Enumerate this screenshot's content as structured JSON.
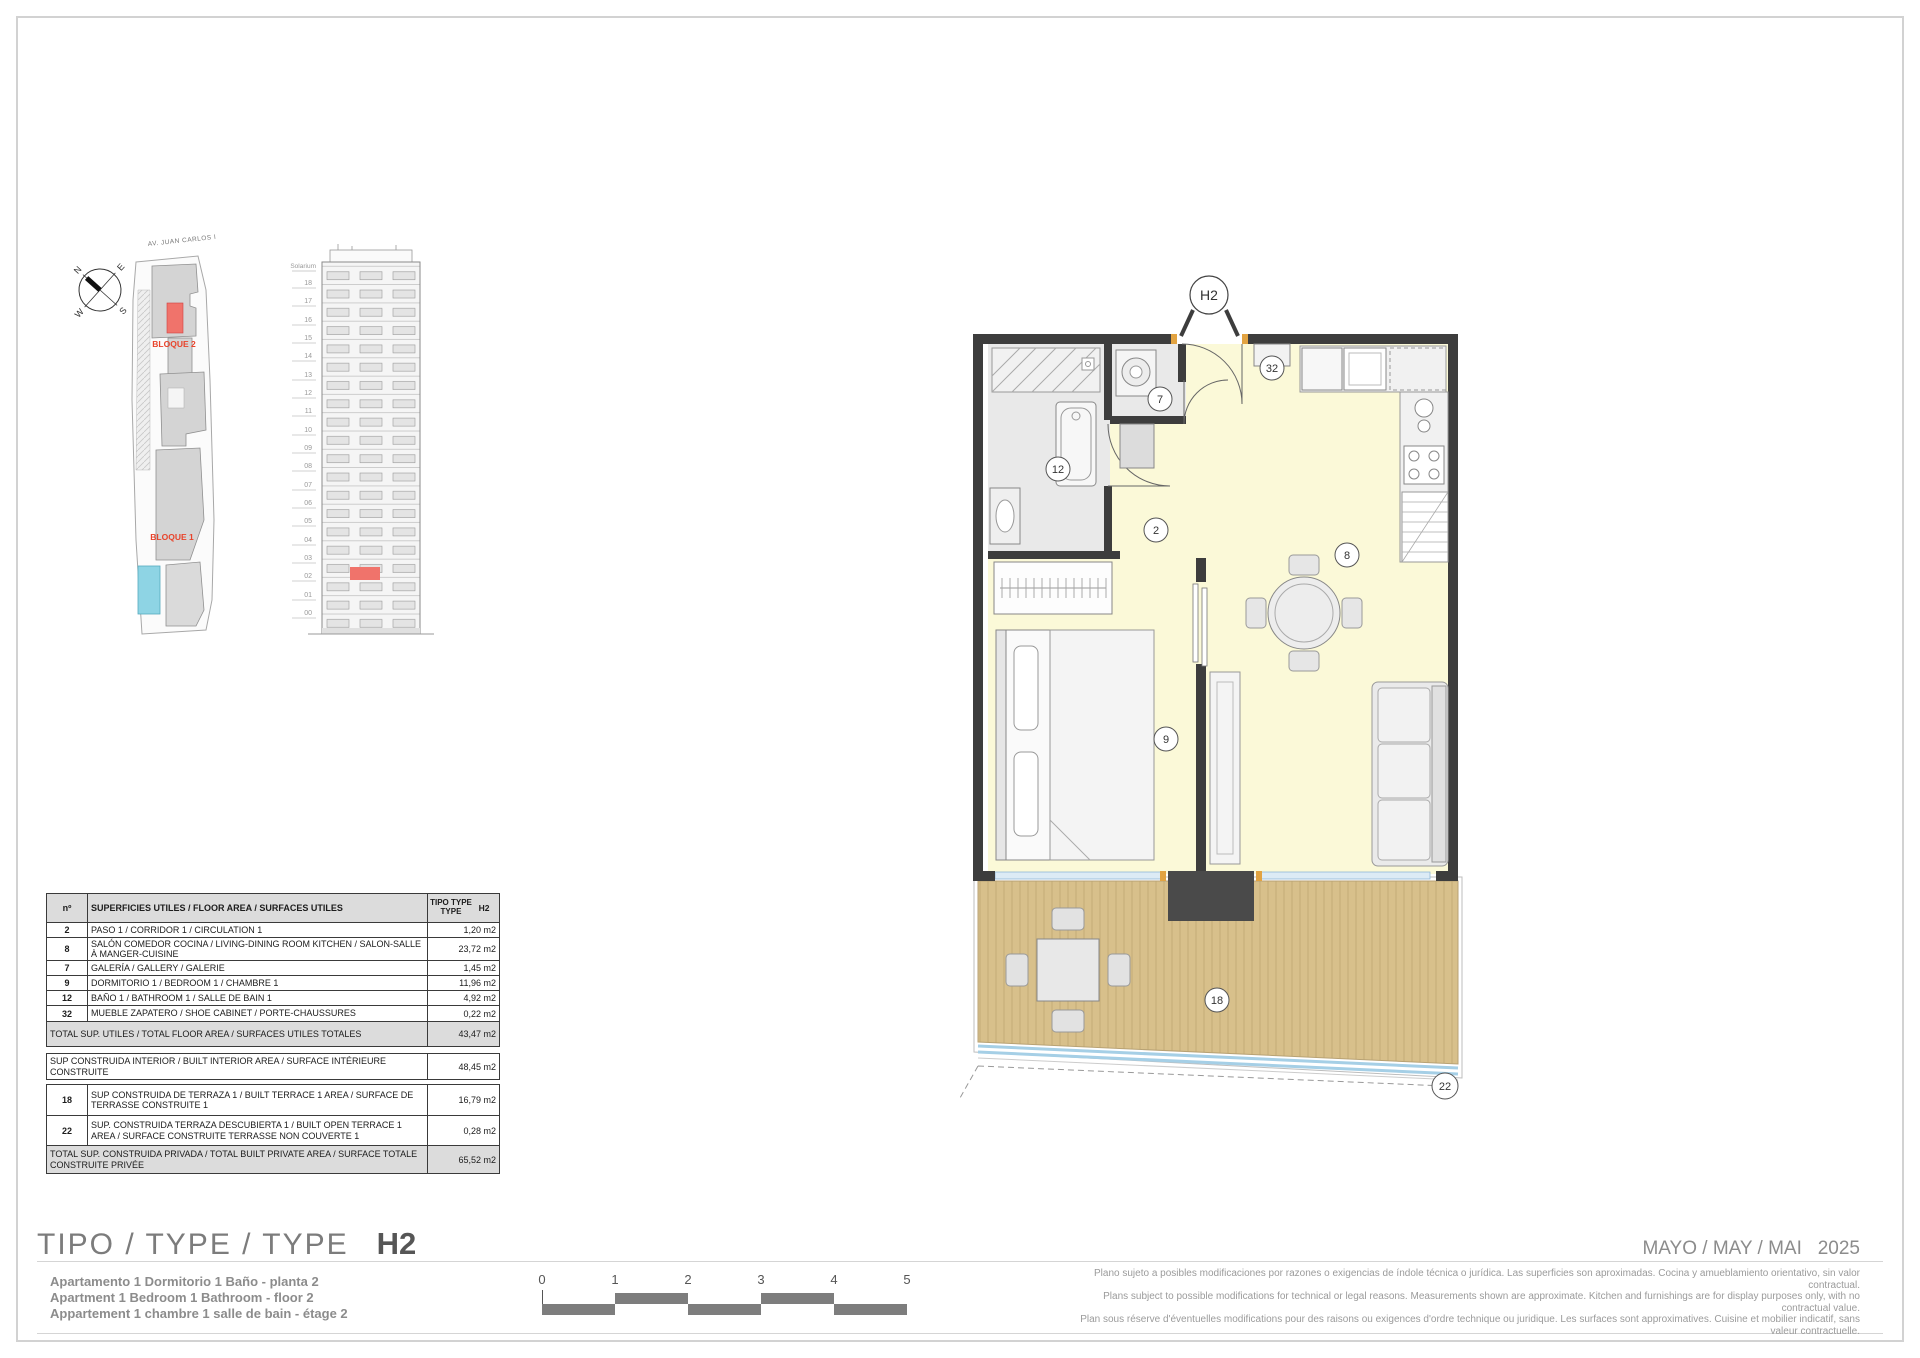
{
  "page": {
    "title_label": "TIPO / TYPE / TYPE",
    "title_value": "H2",
    "date_text": "MAYO / MAY / MAI",
    "year_text": "2025",
    "description_lines": [
      "Apartamento 1 Dormitorio 1 Baño - planta 2",
      "Apartment 1 Bedroom 1 Bathroom - floor 2",
      "Appartement 1 chambre 1 salle de bain - étage 2"
    ],
    "disclaimer_lines": [
      "Plano sujeto a posibles modificaciones por razones o exigencias de índole técnica o jurídica. Las superficies son aproximadas. Cocina y amueblamiento orientativo, sin valor contractual.",
      "Plans subject to possible modifications for technical or legal reasons. Measurements shown are approximate. Kitchen and furnishings are for display purposes only, with no contractual value.",
      "Plan sous réserve d'éventuelles modifications pour des raisons ou exigences d'ordre technique ou juridique. Les surfaces sont approximatives. Cuisine et mobilier indicatif, sans valeur contractuelle."
    ]
  },
  "site_plan": {
    "street_label": "AV. JUAN CARLOS I",
    "bloque2_label": "BLOQUE 2",
    "bloque1_label": "BLOQUE 1",
    "compass": {
      "n": "N",
      "e": "E",
      "s": "S",
      "w": "W"
    }
  },
  "elevation": {
    "top_label": "Solarium",
    "floors": [
      "18",
      "17",
      "16",
      "15",
      "14",
      "13",
      "12",
      "11",
      "10",
      "09",
      "08",
      "07",
      "06",
      "05",
      "04",
      "03",
      "02",
      "01",
      "00"
    ],
    "highlight_floor": "02"
  },
  "floor_plan": {
    "unit_circle_label": "H2",
    "rooms": {
      "corridor_no": "2",
      "gallery_no": "7",
      "living_no": "8",
      "bedroom_no": "9",
      "bathroom_no": "12",
      "terrace_no": "18",
      "open_terrace_no": "22",
      "shoe_cabinet_no": "32"
    }
  },
  "area_table": {
    "header": {
      "no": "nº",
      "desc": "SUPERFICIES UTILES / FLOOR AREA / SURFACES UTILES",
      "type_label": "TIPO TYPE TYPE",
      "type_value": "H2"
    },
    "rows": [
      {
        "no": "2",
        "desc": "PASO 1 / CORRIDOR 1 / CIRCULATION 1",
        "value": "1,20 m2"
      },
      {
        "no": "8",
        "desc": "SALÓN COMEDOR COCINA / LIVING-DINING ROOM KITCHEN / SALON-SALLE À MANGER-CUISINE",
        "value": "23,72 m2"
      },
      {
        "no": "7",
        "desc": "GALERÍA / GALLERY / GALERIE",
        "value": "1,45 m2"
      },
      {
        "no": "9",
        "desc": "DORMITORIO 1 / BEDROOM 1 / CHAMBRE 1",
        "value": "11,96 m2"
      },
      {
        "no": "12",
        "desc": "BAÑO 1 / BATHROOM 1 / SALLE DE BAIN 1",
        "value": "4,92 m2"
      },
      {
        "no": "32",
        "desc": "MUEBLE ZAPATERO / SHOE CABINET / PORTE-CHAUSSURES",
        "value": "0,22 m2"
      }
    ],
    "total_utiles": {
      "desc": "TOTAL SUP. UTILES / TOTAL FLOOR AREA / SURFACES UTILES TOTALES",
      "value": "43,47 m2"
    },
    "interior": {
      "desc": "SUP CONSTRUIDA INTERIOR / BUILT INTERIOR AREA / SURFACE INTÉRIEURE CONSTRUITE",
      "value": "48,45 m2"
    },
    "terrace_rows": [
      {
        "no": "18",
        "desc": "SUP CONSTRUIDA DE TERRAZA 1 / BUILT TERRACE 1 AREA / SURFACE DE TERRASSE CONSTRUITE 1",
        "value": "16,79 m2"
      },
      {
        "no": "22",
        "desc": "SUP. CONSTRUIDA TERRAZA DESCUBIERTA 1 / BUILT OPEN TERRACE 1 AREA / SURFACE CONSTRUITE TERRASSE NON COUVERTE 1",
        "value": "0,28 m2"
      }
    ],
    "total_privada": {
      "desc": "TOTAL SUP. CONSTRUIDA PRIVADA / TOTAL  BUILT PRIVATE AREA / SURFACE TOTALE CONSTRUITE PRIVÉE",
      "value": "65,52 m2"
    }
  },
  "scale_bar": {
    "ticks": [
      "0",
      "1",
      "2",
      "3",
      "4",
      "5"
    ]
  },
  "colors": {
    "accent_red": "#e8432b",
    "unit_highlight": "#f0736b",
    "floor_yellow": "#fbf9d8",
    "wet_gray": "#e9e9e9",
    "wall_dark": "#3d3d3d",
    "deck_tan": "#d8c08b",
    "railing_blue": "#a5cfe6",
    "pool_blue": "#8ed4e4"
  }
}
